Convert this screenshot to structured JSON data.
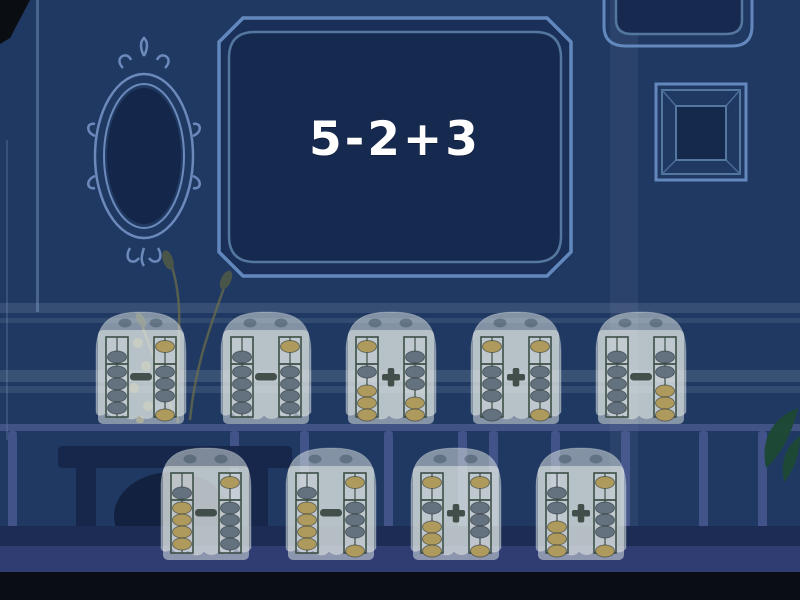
{
  "question": {
    "text": "5-2+3"
  },
  "colors": {
    "wall": "#203962",
    "frame_line": "#6288bd",
    "frame_interior": "#15294d",
    "rod_frame": "#3d4f47",
    "bead_gray": "#64727f",
    "bead_tan": "#ad9a5c",
    "operator": "#2e3b34",
    "question_text": "#ffffff"
  },
  "answers": {
    "rows": [
      [
        {
          "id": 1,
          "operator": "-",
          "expression": "9-3",
          "left": {
            "heaven_pos": "bar",
            "heaven_color": "gray",
            "earth_up": 4,
            "earth_colors": [
              "gray",
              "gray",
              "gray",
              "gray"
            ],
            "value": 9
          },
          "right": {
            "heaven_pos": "top",
            "heaven_color": "tan",
            "earth_up": 3,
            "earth_colors": [
              "gray",
              "gray",
              "gray",
              "tan"
            ],
            "value": 3
          }
        },
        {
          "id": 2,
          "operator": "-",
          "expression": "9-4",
          "left": {
            "heaven_pos": "bar",
            "heaven_color": "gray",
            "earth_up": 4,
            "earth_colors": [
              "gray",
              "gray",
              "gray",
              "gray"
            ],
            "value": 9
          },
          "right": {
            "heaven_pos": "top",
            "heaven_color": "tan",
            "earth_up": 4,
            "earth_colors": [
              "gray",
              "gray",
              "gray",
              "gray"
            ],
            "value": 4
          }
        },
        {
          "id": 3,
          "operator": "+",
          "expression": "1+7",
          "left": {
            "heaven_pos": "top",
            "heaven_color": "tan",
            "earth_up": 1,
            "earth_colors": [
              "gray",
              "tan",
              "tan",
              "tan"
            ],
            "value": 1
          },
          "right": {
            "heaven_pos": "bar",
            "heaven_color": "gray",
            "earth_up": 2,
            "earth_colors": [
              "gray",
              "gray",
              "tan",
              "tan"
            ],
            "value": 7
          }
        },
        {
          "id": 4,
          "operator": "+",
          "expression": "3+3",
          "left": {
            "heaven_pos": "top",
            "heaven_color": "tan",
            "earth_up": 3,
            "earth_colors": [
              "gray",
              "gray",
              "gray",
              "gray"
            ],
            "value": 3
          },
          "right": {
            "heaven_pos": "top",
            "heaven_color": "tan",
            "earth_up": 3,
            "earth_colors": [
              "gray",
              "gray",
              "gray",
              "tan"
            ],
            "value": 3
          }
        },
        {
          "id": 5,
          "operator": "-",
          "expression": "9-6",
          "left": {
            "heaven_pos": "bar",
            "heaven_color": "gray",
            "earth_up": 4,
            "earth_colors": [
              "gray",
              "gray",
              "gray",
              "gray"
            ],
            "value": 9
          },
          "right": {
            "heaven_pos": "bar",
            "heaven_color": "gray",
            "earth_up": 1,
            "earth_colors": [
              "gray",
              "tan",
              "tan",
              "tan"
            ],
            "value": 6
          }
        }
      ],
      [
        {
          "id": 6,
          "operator": "-",
          "expression": "9-4",
          "left": {
            "heaven_pos": "bar",
            "heaven_color": "gray",
            "earth_up": 4,
            "earth_colors": [
              "tan",
              "tan",
              "tan",
              "tan"
            ],
            "value": 9
          },
          "right": {
            "heaven_pos": "top",
            "heaven_color": "tan",
            "earth_up": 4,
            "earth_colors": [
              "gray",
              "gray",
              "gray",
              "gray"
            ],
            "value": 4
          }
        },
        {
          "id": 7,
          "operator": "-",
          "expression": "9-3",
          "left": {
            "heaven_pos": "bar",
            "heaven_color": "gray",
            "earth_up": 4,
            "earth_colors": [
              "tan",
              "tan",
              "tan",
              "tan"
            ],
            "value": 9
          },
          "right": {
            "heaven_pos": "top",
            "heaven_color": "tan",
            "earth_up": 3,
            "earth_colors": [
              "gray",
              "gray",
              "gray",
              "tan"
            ],
            "value": 3
          }
        },
        {
          "id": 8,
          "operator": "+",
          "expression": "1+3",
          "left": {
            "heaven_pos": "top",
            "heaven_color": "tan",
            "earth_up": 1,
            "earth_colors": [
              "gray",
              "tan",
              "tan",
              "tan"
            ],
            "value": 1
          },
          "right": {
            "heaven_pos": "top",
            "heaven_color": "tan",
            "earth_up": 3,
            "earth_colors": [
              "gray",
              "gray",
              "gray",
              "tan"
            ],
            "value": 3
          }
        },
        {
          "id": 9,
          "operator": "+",
          "expression": "6+3",
          "left": {
            "heaven_pos": "bar",
            "heaven_color": "gray",
            "earth_up": 1,
            "earth_colors": [
              "gray",
              "tan",
              "tan",
              "tan"
            ],
            "value": 6
          },
          "right": {
            "heaven_pos": "top",
            "heaven_color": "tan",
            "earth_up": 3,
            "earth_colors": [
              "gray",
              "gray",
              "gray",
              "tan"
            ],
            "value": 3
          }
        }
      ]
    ]
  }
}
